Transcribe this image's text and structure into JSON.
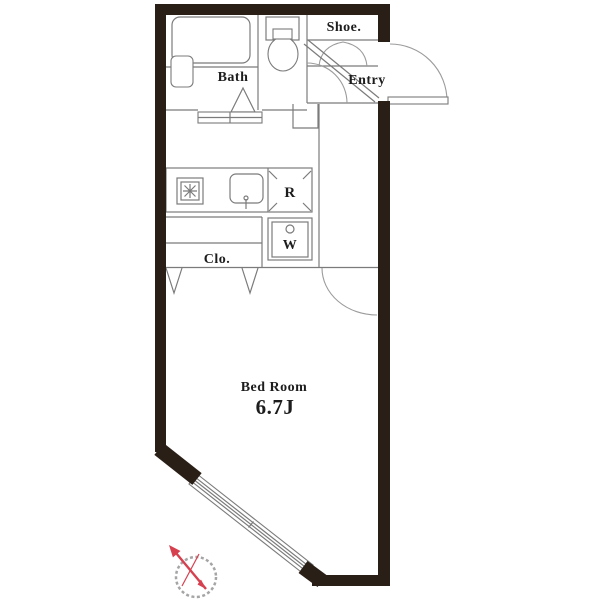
{
  "plan": {
    "title": "Studio apartment floor plan",
    "labels": {
      "bath": "Bath",
      "shoe": "Shoe.",
      "entry": "Entry",
      "fridge": "R",
      "washer": "W",
      "closet": "Clo.",
      "bedroom_name": "Bed Room",
      "bedroom_size": "6.7J"
    },
    "colors": {
      "wall": "#2a1f17",
      "interior_line": "#7b7b7b",
      "door_arc": "#9b9b9b",
      "label_text": "#1d1d1d",
      "compass_needle": "#d6404f"
    }
  }
}
